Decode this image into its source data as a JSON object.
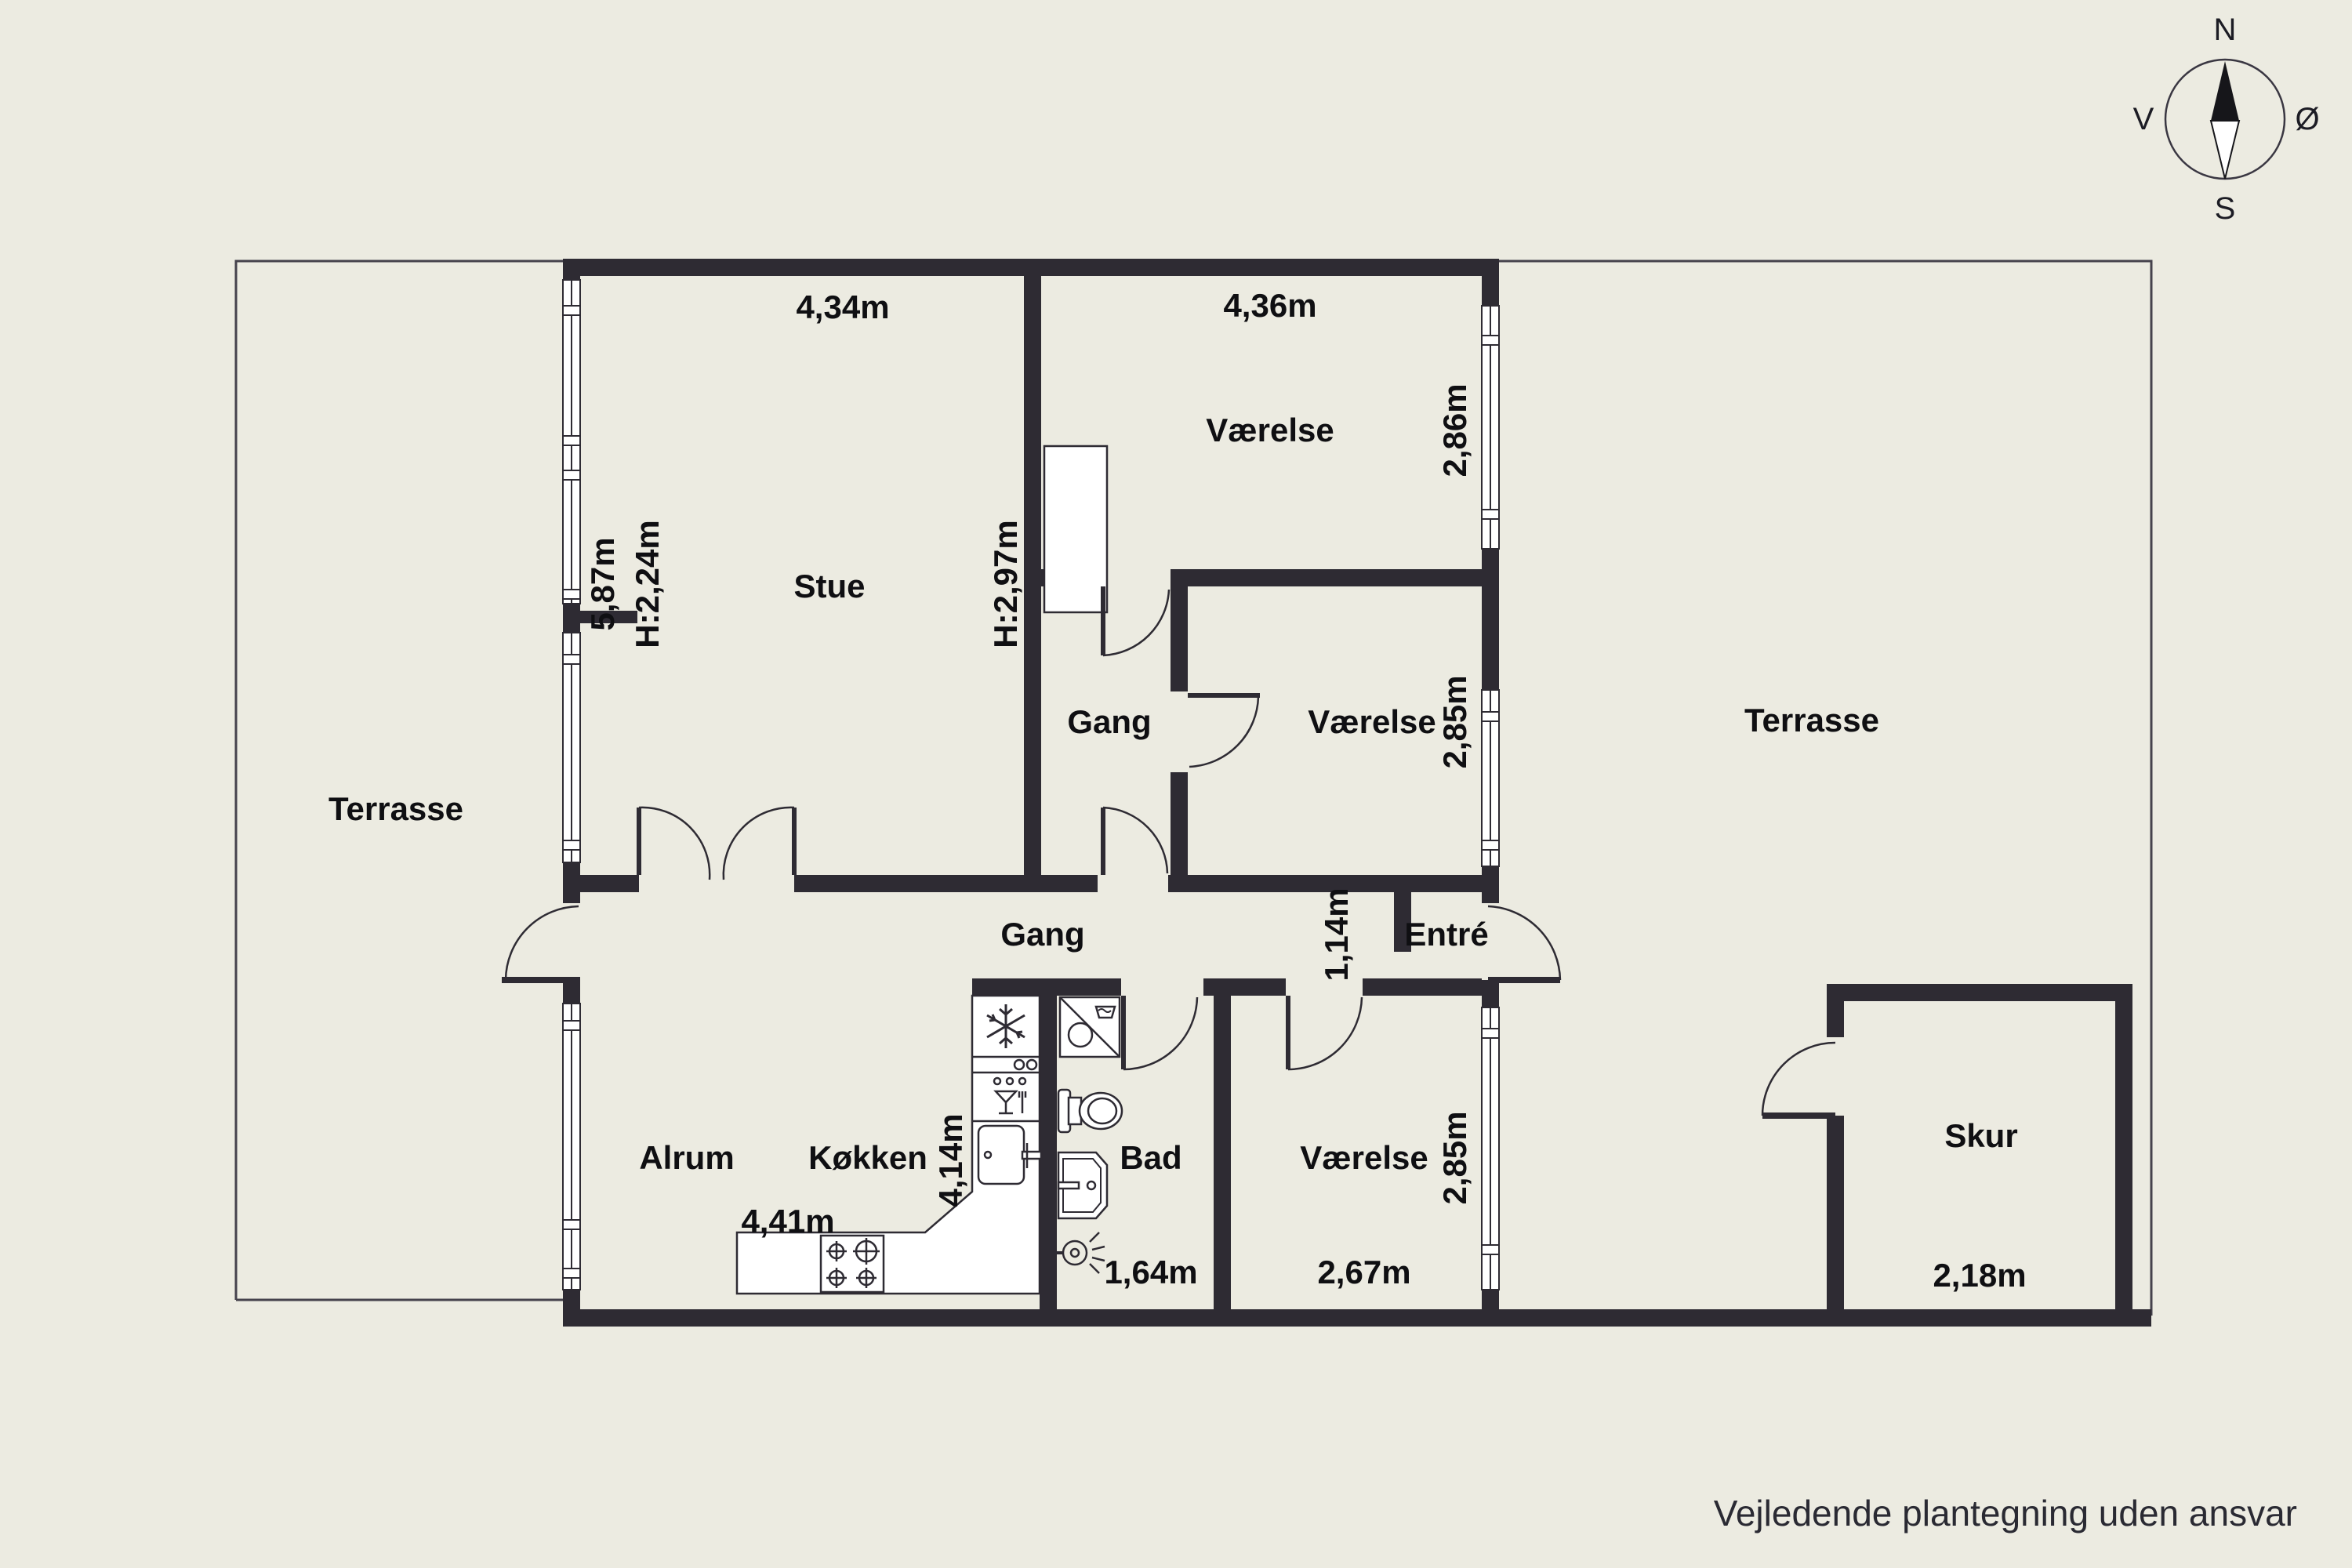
{
  "labels": {
    "stue": "Stue",
    "vaerelse_top": "Værelse",
    "vaerelse_mid": "Værelse",
    "vaerelse_bottom": "Værelse",
    "gang_upper": "Gang",
    "gang_lower": "Gang",
    "entre": "Entré",
    "alrum": "Alrum",
    "koekken": "Køkken",
    "bad": "Bad",
    "skur": "Skur",
    "terrasse_left": "Terrasse",
    "terrasse_right": "Terrasse"
  },
  "dimensions": {
    "stue_width": "4,34m",
    "stue_depth": "5,87m",
    "stue_ceiling": "H:2,24m",
    "stue_ceiling2": "H:2,97m",
    "vaerelse_top_width": "4,36m",
    "vaerelse_top_depth": "2,86m",
    "vaerelse_mid_depth": "2,85m",
    "corridor_width": "1,14m",
    "alrum_width": "4,41m",
    "koekken_depth": "4,14m",
    "bad_width": "1,64m",
    "vaerelse_bottom_width": "2,67m",
    "vaerelse_bottom_depth": "2,85m",
    "skur_width": "2,18m"
  },
  "compass": {
    "north": "N",
    "south": "S",
    "west": "V",
    "east": "Ø"
  },
  "footer": {
    "disclaimer": "Vejledende plantegning uden ansvar"
  },
  "colors": {
    "background": "#ECEBE1",
    "wall": "#2E2B33",
    "label_text": "#0F0F12",
    "outline": "#45424C",
    "fixture_fill": "#FFFFFF"
  }
}
